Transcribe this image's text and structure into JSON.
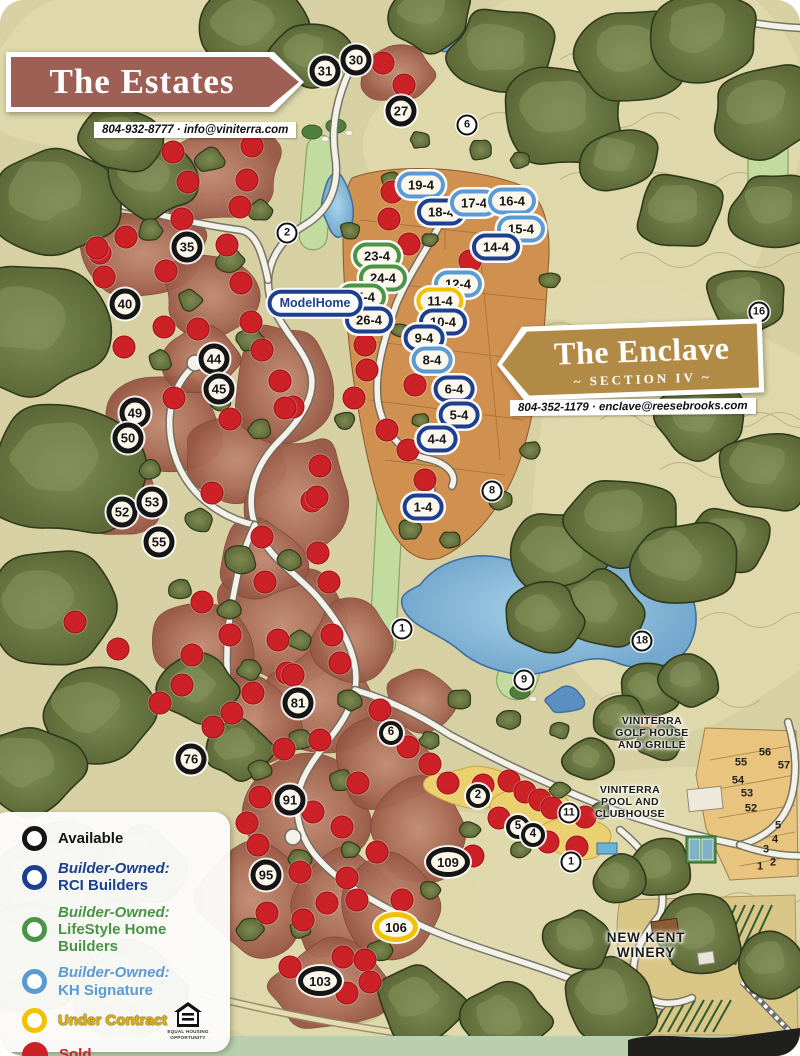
{
  "estates_banner": {
    "title": "The Estates",
    "contact": "804-932-8777  ·  info@viniterra.com"
  },
  "enclave_banner": {
    "title": "The Enclave",
    "subtitle": "~ SECTION IV ~",
    "contact": "804-352-1179  ·  enclave@reesebrooks.com"
  },
  "colors": {
    "available": "#151515",
    "rci": "#1d3f8f",
    "lifestyle": "#4a9445",
    "kh": "#5b9bd5",
    "under_contract": "#f2c100",
    "sold": "#cb2127",
    "estates_banner": "#9e6055",
    "enclave_banner": "#b18b45"
  },
  "legend": {
    "items": [
      {
        "key": "available",
        "style": "ring",
        "color": "#151515",
        "lines": [
          "Available"
        ],
        "text_colors": [
          "#151515"
        ]
      },
      {
        "key": "rci",
        "style": "ring",
        "color": "#1d3f8f",
        "lines": [
          "Builder-Owned:",
          "RCI Builders"
        ],
        "text_colors": [
          "#1d3f8f",
          "#1d3f8f"
        ]
      },
      {
        "key": "lifestyle",
        "style": "ring",
        "color": "#4a9445",
        "lines": [
          "Builder-Owned:",
          "LifeStyle Home Builders"
        ],
        "text_colors": [
          "#4a9445",
          "#4a9445"
        ]
      },
      {
        "key": "kh",
        "style": "ring",
        "color": "#5b9bd5",
        "lines": [
          "Builder-Owned:",
          "KH Signature"
        ],
        "text_colors": [
          "#5b9bd5",
          "#5b9bd5"
        ]
      },
      {
        "key": "under_contract",
        "style": "ring",
        "color": "#f2c100",
        "lines": [
          "Under Contract"
        ],
        "text_colors": [
          "#e2ae00"
        ]
      },
      {
        "key": "sold",
        "style": "dot",
        "color": "#cb2127",
        "lines": [
          "Sold"
        ],
        "text_colors": [
          "#cb2127"
        ]
      }
    ],
    "equal_housing_caption": "EQUAL HOUSING OPPORTUNITY"
  },
  "markers": {
    "available_lots": [
      {
        "n": "31",
        "x": 325,
        "y": 71,
        "s": "md"
      },
      {
        "n": "30",
        "x": 356,
        "y": 60,
        "s": "md"
      },
      {
        "n": "27",
        "x": 401,
        "y": 111,
        "s": "md"
      },
      {
        "n": "35",
        "x": 187,
        "y": 247,
        "s": "md"
      },
      {
        "n": "40",
        "x": 125,
        "y": 304,
        "s": "md"
      },
      {
        "n": "44",
        "x": 214,
        "y": 359,
        "s": "md"
      },
      {
        "n": "45",
        "x": 219,
        "y": 389,
        "s": "md"
      },
      {
        "n": "49",
        "x": 135,
        "y": 413,
        "s": "md"
      },
      {
        "n": "50",
        "x": 128,
        "y": 438,
        "s": "md"
      },
      {
        "n": "52",
        "x": 122,
        "y": 512,
        "s": "md"
      },
      {
        "n": "53",
        "x": 152,
        "y": 502,
        "s": "md"
      },
      {
        "n": "55",
        "x": 159,
        "y": 542,
        "s": "md"
      },
      {
        "n": "81",
        "x": 298,
        "y": 703,
        "s": "md"
      },
      {
        "n": "76",
        "x": 191,
        "y": 759,
        "s": "md"
      },
      {
        "n": "91",
        "x": 290,
        "y": 800,
        "s": "md"
      },
      {
        "n": "95",
        "x": 266,
        "y": 875,
        "s": "md"
      },
      {
        "n": "109",
        "x": 448,
        "y": 862,
        "s": "wide"
      },
      {
        "n": "103",
        "x": 320,
        "y": 981,
        "s": "wide"
      },
      {
        "n": "6",
        "x": 391,
        "y": 733,
        "s": "sm"
      },
      {
        "n": "2",
        "x": 478,
        "y": 796,
        "s": "sm"
      },
      {
        "n": "5",
        "x": 518,
        "y": 827,
        "s": "sm"
      },
      {
        "n": "4",
        "x": 533,
        "y": 835,
        "s": "sm"
      }
    ],
    "under_contract_lots": [
      {
        "n": "106",
        "x": 396,
        "y": 927
      }
    ],
    "golf_holes": [
      {
        "n": "6",
        "x": 467,
        "y": 125
      },
      {
        "n": "2",
        "x": 287,
        "y": 233
      },
      {
        "n": "16",
        "x": 759,
        "y": 312
      },
      {
        "n": "8",
        "x": 492,
        "y": 491
      },
      {
        "n": "1",
        "x": 402,
        "y": 629
      },
      {
        "n": "18",
        "x": 642,
        "y": 641
      },
      {
        "n": "9",
        "x": 524,
        "y": 680
      },
      {
        "n": "11",
        "x": 569,
        "y": 813
      },
      {
        "n": "1",
        "x": 571,
        "y": 862
      }
    ],
    "enclave_lots": [
      {
        "n": "19-4",
        "builder": "kh",
        "x": 421,
        "y": 185
      },
      {
        "n": "18-4",
        "builder": "rci",
        "x": 441,
        "y": 212
      },
      {
        "n": "17-4",
        "builder": "kh",
        "x": 474,
        "y": 203
      },
      {
        "n": "16-4",
        "builder": "kh",
        "x": 512,
        "y": 201
      },
      {
        "n": "15-4",
        "builder": "kh",
        "x": 521,
        "y": 229
      },
      {
        "n": "14-4",
        "builder": "rci",
        "x": 496,
        "y": 247
      },
      {
        "n": "23-4",
        "builder": "lifestyle",
        "x": 377,
        "y": 256
      },
      {
        "n": "24-4",
        "builder": "lifestyle",
        "x": 383,
        "y": 278
      },
      {
        "n": "25-4",
        "builder": "lifestyle",
        "x": 362,
        "y": 297
      },
      {
        "n": "26-4",
        "builder": "rci",
        "x": 369,
        "y": 320
      },
      {
        "n": "12-4",
        "builder": "kh",
        "x": 458,
        "y": 284
      },
      {
        "n": "11-4",
        "builder": "under_contract",
        "x": 440,
        "y": 301
      },
      {
        "n": "10-4",
        "builder": "rci",
        "x": 443,
        "y": 322
      },
      {
        "n": "9-4",
        "builder": "rci",
        "x": 424,
        "y": 338
      },
      {
        "n": "8-4",
        "builder": "kh",
        "x": 432,
        "y": 360
      },
      {
        "n": "6-4",
        "builder": "rci",
        "x": 454,
        "y": 389
      },
      {
        "n": "5-4",
        "builder": "rci",
        "x": 459,
        "y": 415
      },
      {
        "n": "4-4",
        "builder": "rci",
        "x": 437,
        "y": 439
      },
      {
        "n": "1-4",
        "builder": "rci",
        "x": 423,
        "y": 507
      }
    ],
    "model_home": {
      "lines": [
        "Model",
        "Home"
      ],
      "x": 315,
      "y": 303
    },
    "plain_lot_numbers": [
      {
        "n": "56",
        "x": 765,
        "y": 753
      },
      {
        "n": "55",
        "x": 741,
        "y": 763
      },
      {
        "n": "57",
        "x": 784,
        "y": 766
      },
      {
        "n": "54",
        "x": 738,
        "y": 781
      },
      {
        "n": "53",
        "x": 747,
        "y": 794
      },
      {
        "n": "52",
        "x": 751,
        "y": 809
      },
      {
        "n": "5",
        "x": 778,
        "y": 826
      },
      {
        "n": "4",
        "x": 775,
        "y": 840
      },
      {
        "n": "3",
        "x": 766,
        "y": 850
      },
      {
        "n": "2",
        "x": 773,
        "y": 863
      },
      {
        "n": "1",
        "x": 760,
        "y": 867
      }
    ],
    "sold_dots": [
      [
        383,
        63
      ],
      [
        404,
        85
      ],
      [
        173,
        152
      ],
      [
        252,
        146
      ],
      [
        188,
        182
      ],
      [
        247,
        180
      ],
      [
        182,
        219
      ],
      [
        240,
        207
      ],
      [
        126,
        237
      ],
      [
        100,
        253
      ],
      [
        97,
        248
      ],
      [
        227,
        245
      ],
      [
        166,
        271
      ],
      [
        104,
        277
      ],
      [
        241,
        283
      ],
      [
        164,
        327
      ],
      [
        198,
        329
      ],
      [
        251,
        322
      ],
      [
        124,
        347
      ],
      [
        262,
        350
      ],
      [
        174,
        398
      ],
      [
        230,
        419
      ],
      [
        293,
        407
      ],
      [
        280,
        381
      ],
      [
        285,
        408
      ],
      [
        320,
        466
      ],
      [
        312,
        501
      ],
      [
        212,
        493
      ],
      [
        317,
        497
      ],
      [
        262,
        537
      ],
      [
        318,
        553
      ],
      [
        265,
        582
      ],
      [
        329,
        582
      ],
      [
        202,
        602
      ],
      [
        230,
        635
      ],
      [
        278,
        640
      ],
      [
        332,
        635
      ],
      [
        192,
        655
      ],
      [
        287,
        673
      ],
      [
        340,
        663
      ],
      [
        75,
        622
      ],
      [
        118,
        649
      ],
      [
        182,
        685
      ],
      [
        253,
        693
      ],
      [
        160,
        703
      ],
      [
        232,
        713
      ],
      [
        293,
        675
      ],
      [
        213,
        727
      ],
      [
        320,
        740
      ],
      [
        284,
        749
      ],
      [
        380,
        710
      ],
      [
        408,
        747
      ],
      [
        358,
        783
      ],
      [
        260,
        797
      ],
      [
        313,
        812
      ],
      [
        247,
        823
      ],
      [
        342,
        827
      ],
      [
        377,
        852
      ],
      [
        258,
        845
      ],
      [
        300,
        872
      ],
      [
        347,
        878
      ],
      [
        430,
        764
      ],
      [
        448,
        783
      ],
      [
        483,
        785
      ],
      [
        509,
        781
      ],
      [
        525,
        792
      ],
      [
        540,
        800
      ],
      [
        552,
        808
      ],
      [
        585,
        817
      ],
      [
        499,
        818
      ],
      [
        548,
        842
      ],
      [
        577,
        847
      ],
      [
        473,
        856
      ],
      [
        327,
        903
      ],
      [
        402,
        900
      ],
      [
        357,
        900
      ],
      [
        303,
        920
      ],
      [
        267,
        913
      ],
      [
        290,
        967
      ],
      [
        343,
        957
      ],
      [
        365,
        960
      ],
      [
        370,
        982
      ],
      [
        347,
        993
      ],
      [
        392,
        192
      ],
      [
        389,
        219
      ],
      [
        409,
        244
      ],
      [
        470,
        261
      ],
      [
        415,
        385
      ],
      [
        365,
        345
      ],
      [
        367,
        370
      ],
      [
        354,
        398
      ],
      [
        387,
        430
      ],
      [
        408,
        450
      ],
      [
        425,
        480
      ]
    ]
  },
  "map_labels": [
    {
      "id": "golf-house-label",
      "cls": "small",
      "lines": [
        "VINITERRA",
        "GOLF HOUSE",
        "AND GRILLE"
      ],
      "x": 652,
      "y": 733
    },
    {
      "id": "pool-clubhouse-label",
      "cls": "small",
      "lines": [
        "VINITERRA",
        "POOL AND",
        "CLUBHOUSE"
      ],
      "x": 630,
      "y": 802
    },
    {
      "id": "winery-label",
      "cls": "big",
      "lines": [
        "NEW KENT",
        "WINERY"
      ],
      "x": 646,
      "y": 945
    }
  ]
}
